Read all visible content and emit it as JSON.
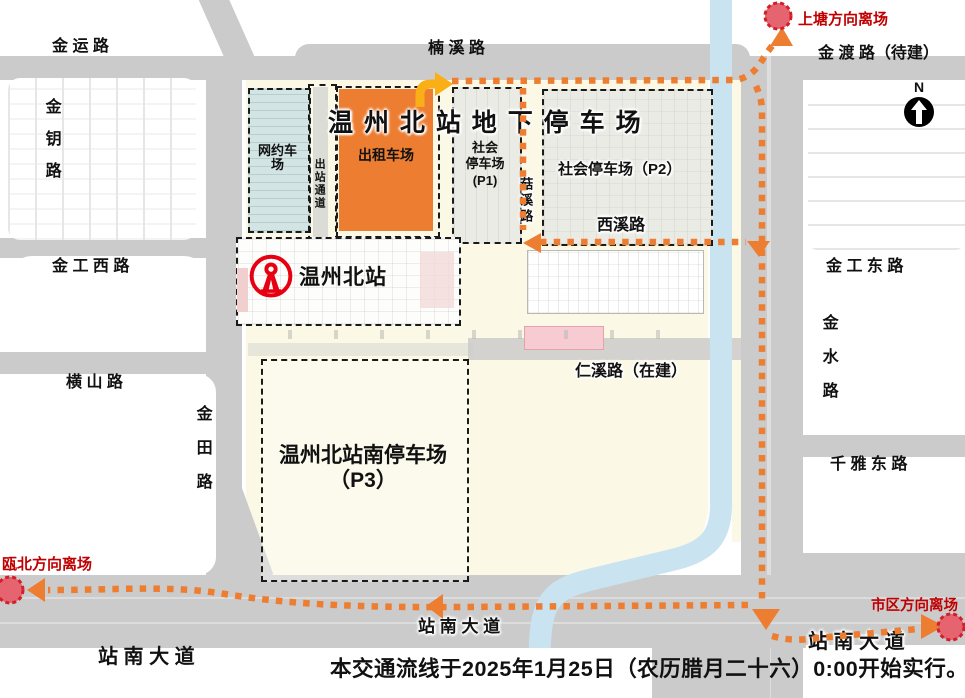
{
  "colors": {
    "flow_orange": "#ED7D31",
    "start_arrow_yellow": "#FBAF17",
    "taxi_lot_orange": "#ED7D31",
    "ride_hail_teal": "#D2E4E4",
    "endpoint_fill": "#E56470",
    "endpoint_border": "#D0202A",
    "red_text": "#C00000",
    "river_blue": "#C9E4F0",
    "road_gray": "#CBCBCB",
    "plot_cream": "#FBF8E5",
    "railway_logo_red": "#E60012"
  },
  "roads": {
    "jinyun": "金 运 路",
    "nanxi": "楠 溪 路",
    "jindu": "金 渡 路（待建）",
    "jinyue": "金钥路",
    "jingong_west": "金 工 西 路",
    "hengshan": "横 山 路",
    "jintian": "金田路",
    "jingong_east": "金 工 东 路",
    "jinshui": "金水路",
    "qianya_east": "千 雅 东 路",
    "zhannan_left": "站 南 大 道",
    "zhannan_center": "站 南 大 道",
    "zhannan_right": "站 南 大 道",
    "guxi": "菇溪路",
    "xixi": "西溪路",
    "renxi": "仁溪路（在建）"
  },
  "zones": {
    "main_title": "温 州 北 站 地 下 停 车 场",
    "wangyuche_line1": "网约车",
    "wangyuche_line2": "场",
    "chuzhan_tongdao": "出站通道",
    "chuzuche": "出租车场",
    "p1_line1": "社会",
    "p1_line2": "停车场",
    "p1_line3": "(P1)",
    "p2": "社会停车场（P2）",
    "p3_line1": "温州北站南停车场",
    "p3_line2": "（P3）",
    "station_name": "温州北站"
  },
  "departures": {
    "shangtang": "上塘方向离场",
    "oubei": "瓯北方向离场",
    "shiqu": "市区方向离场"
  },
  "compass": {
    "north": "N"
  },
  "notice": "本交通流线于2025年1月25日（农历腊月二十六）0:00开始实行。"
}
